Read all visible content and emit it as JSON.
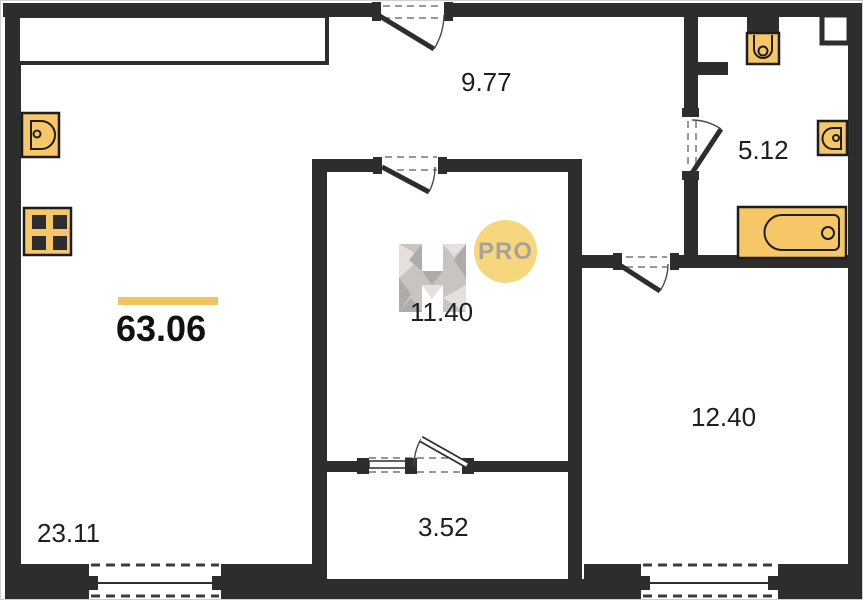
{
  "plan": {
    "title": "apartment-floor-plan",
    "total_area_label": "63.06",
    "badge_label": "PRO",
    "watermark_letter": "H",
    "rooms": [
      {
        "name": "hallway",
        "area_label": "9.77"
      },
      {
        "name": "bathroom",
        "area_label": "5.12"
      },
      {
        "name": "middle-room",
        "area_label": "11.40"
      },
      {
        "name": "right-room",
        "area_label": "12.40"
      },
      {
        "name": "closet",
        "area_label": "3.52"
      },
      {
        "name": "living-kitchen",
        "area_label": "23.11"
      }
    ],
    "icons": [
      "kitchen-sink-icon",
      "stove-icon",
      "toilet-icon",
      "bathroom-sink-icon",
      "bathtub-icon",
      "vent-shaft",
      "kitchen-counter"
    ]
  },
  "colors": {
    "wall": "#2d2d2d",
    "fixture_fill": "#f6c766",
    "fixture_stroke": "#1d1d1b",
    "accent_bar": "#efc45c",
    "pro_badge_fill": "#f6d77d",
    "pro_badge_text": "#a7a29b",
    "dash_door": "#989898",
    "dash_window": "#3c3c3c",
    "label_text": "#1e1e1e",
    "watermark_light": "#e3e0de",
    "watermark_mid": "#c9c4c1",
    "watermark_dark": "#b0aba8"
  }
}
